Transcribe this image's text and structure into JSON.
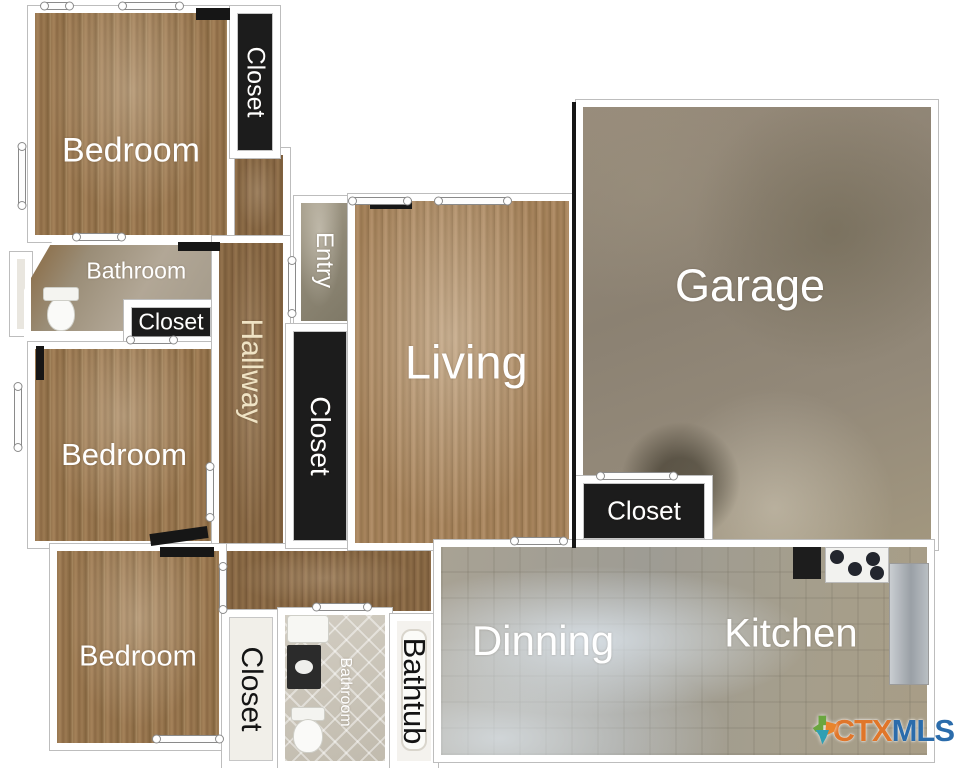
{
  "rooms": {
    "bedroom_top": {
      "label": "Bedroom"
    },
    "closet_top": {
      "label": "Closet"
    },
    "bathroom_main": {
      "label": "Bathroom"
    },
    "closet_bath": {
      "label": "Closet"
    },
    "bedroom_mid": {
      "label": "Bedroom"
    },
    "hallway": {
      "label": "Hallway"
    },
    "entry": {
      "label": "Entry"
    },
    "closet_hall": {
      "label": "Closet"
    },
    "living": {
      "label": "Living"
    },
    "garage": {
      "label": "Garage"
    },
    "closet_garage": {
      "label": "Closet"
    },
    "bedroom_bottom": {
      "label": "Bedroom"
    },
    "closet_bottom": {
      "label": "Closet"
    },
    "bathroom_bottom": {
      "label": "Bathroom"
    },
    "bathtub": {
      "label": "Bathtub"
    },
    "dining": {
      "label": "Dinning"
    },
    "kitchen": {
      "label": "Kitchen"
    }
  },
  "watermark": {
    "ctx": "CTX",
    "mls": "MLS",
    "ctx_color": "#e0762a",
    "mls_color": "#2b6cab",
    "icon": "texas-state-icon",
    "icon_colors": [
      "#6aa63f",
      "#e8842c",
      "#2f9fb3"
    ]
  },
  "colors": {
    "wall": "#ffffff",
    "wall_outline": "#bdbdbd",
    "closet_fill": "#1c1c1c",
    "wood_floor": "#97764f",
    "garage_floor": "#8e8475",
    "tile_floor": "#a7a396",
    "label_light": "#ffffff",
    "label_dark": "#141414",
    "hallway_label_color": "#efe3c4"
  }
}
